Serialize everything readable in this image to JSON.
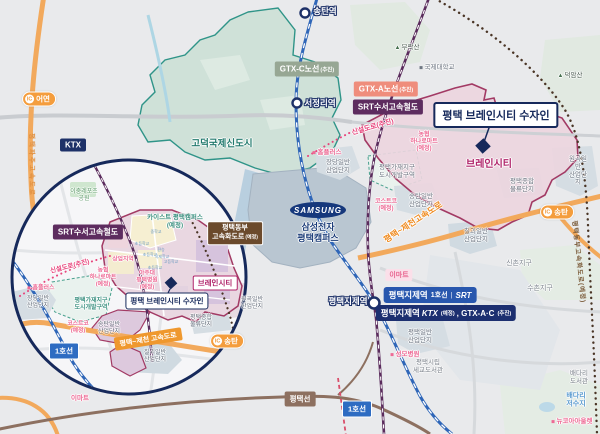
{
  "title": {
    "main": "평택 브레인시티 수자인"
  },
  "stations": {
    "songtan": "송탄역",
    "seojeongni": "서정리역",
    "jije": "평택지제역"
  },
  "rail_badges": {
    "ktx": "KTX",
    "srt_suseo": "SRT수서고속철도",
    "gtx_a": {
      "label": "GTX-A노선",
      "note": "(추진)"
    },
    "gtx_c": {
      "label": "GTX-C노선",
      "note": "(추진)"
    },
    "line1": "1호선",
    "pyeongtaek_line": "평택선"
  },
  "jije_badge1": {
    "name": "평택지제역",
    "line": "1호선",
    "sep": "|",
    "srt": "SRT"
  },
  "jije_badge2": {
    "name": "평택지제역",
    "ktx": "KTX",
    "note1": "(예정)",
    "rest": ", GTX-A·C",
    "note2": "(추진)"
  },
  "ic": {
    "label": "IC",
    "eoyeon": "어연",
    "songtan": "송탄"
  },
  "areas": {
    "godeok": "고덕국제신도시",
    "braincity": "브레인시티",
    "samsung_logo": "SAMSUNG",
    "samsung_name": "삼성전자\n평택캠퍼스"
  },
  "roads": {
    "sinseol": "신설도로(추진)",
    "ptjc_main": "평택~제천고속도로",
    "ptjc_inset": "평택~제천 고속도로",
    "paju_vertical": "평택파주고속도로",
    "east_vertical": "평택동부고속화도로(예정)",
    "east_badge": {
      "line1": "평택동부",
      "line2": "고속화도로",
      "note": "(예정)"
    }
  },
  "pois": {
    "homeplus": "홈플러스",
    "nonghyup": "농협\n하나로마트\n(예정)",
    "costco": "코스트코\n(예정)",
    "emart": "이마트",
    "seongmo": "성모병원",
    "newcore": "뉴코아아울렛",
    "ajou": "아주대\n평택병원\n(예정)",
    "kaist": "카이스트 평택캠퍼스\n(예정)",
    "intl_univ": "국제대학교",
    "leports": "이충레포츠\n공원",
    "sangeop": "상업지역"
  },
  "industrial": {
    "jangdang": "장당일반\n산업단지",
    "songtan": "송탄일반\n산업단지",
    "chilgoe": "칠괴일반\n산업단지",
    "wongok": "원곡일반\n산업단지",
    "logistics": "평택종합\n물류단지",
    "pyeongtaek": "평택일반\n산업단지",
    "gajae": "평택가재지구\n도시개발구역"
  },
  "places": {
    "burak": "부락산",
    "deogam": "덕암산",
    "sinchon": "신촌지구",
    "suchon": "수촌지구",
    "baedari_lib": "배다리도서관",
    "baedari_res": "배다리저수지",
    "segyo_lib": "평택시립\n세교도서관"
  },
  "schools": {
    "middle": "중학교",
    "elem1": "초등학교",
    "elem2": "초등학교",
    "elem3": "초등학교",
    "high": "고등학교",
    "transfer": "환승",
    "intl": "국제학교"
  },
  "colors": {
    "navy": "#16295b",
    "brain_border": "#a23a64",
    "brain_fill": "#ecd5de",
    "orange": "#f2a95c",
    "line1_blue": "#2f66b8",
    "srt_purple": "#5a2b5c",
    "godeok_teal": "#2f9488",
    "gtx_a": "#ef8d7c",
    "gtx_c": "#97a794",
    "magenta": "#b0246a"
  }
}
